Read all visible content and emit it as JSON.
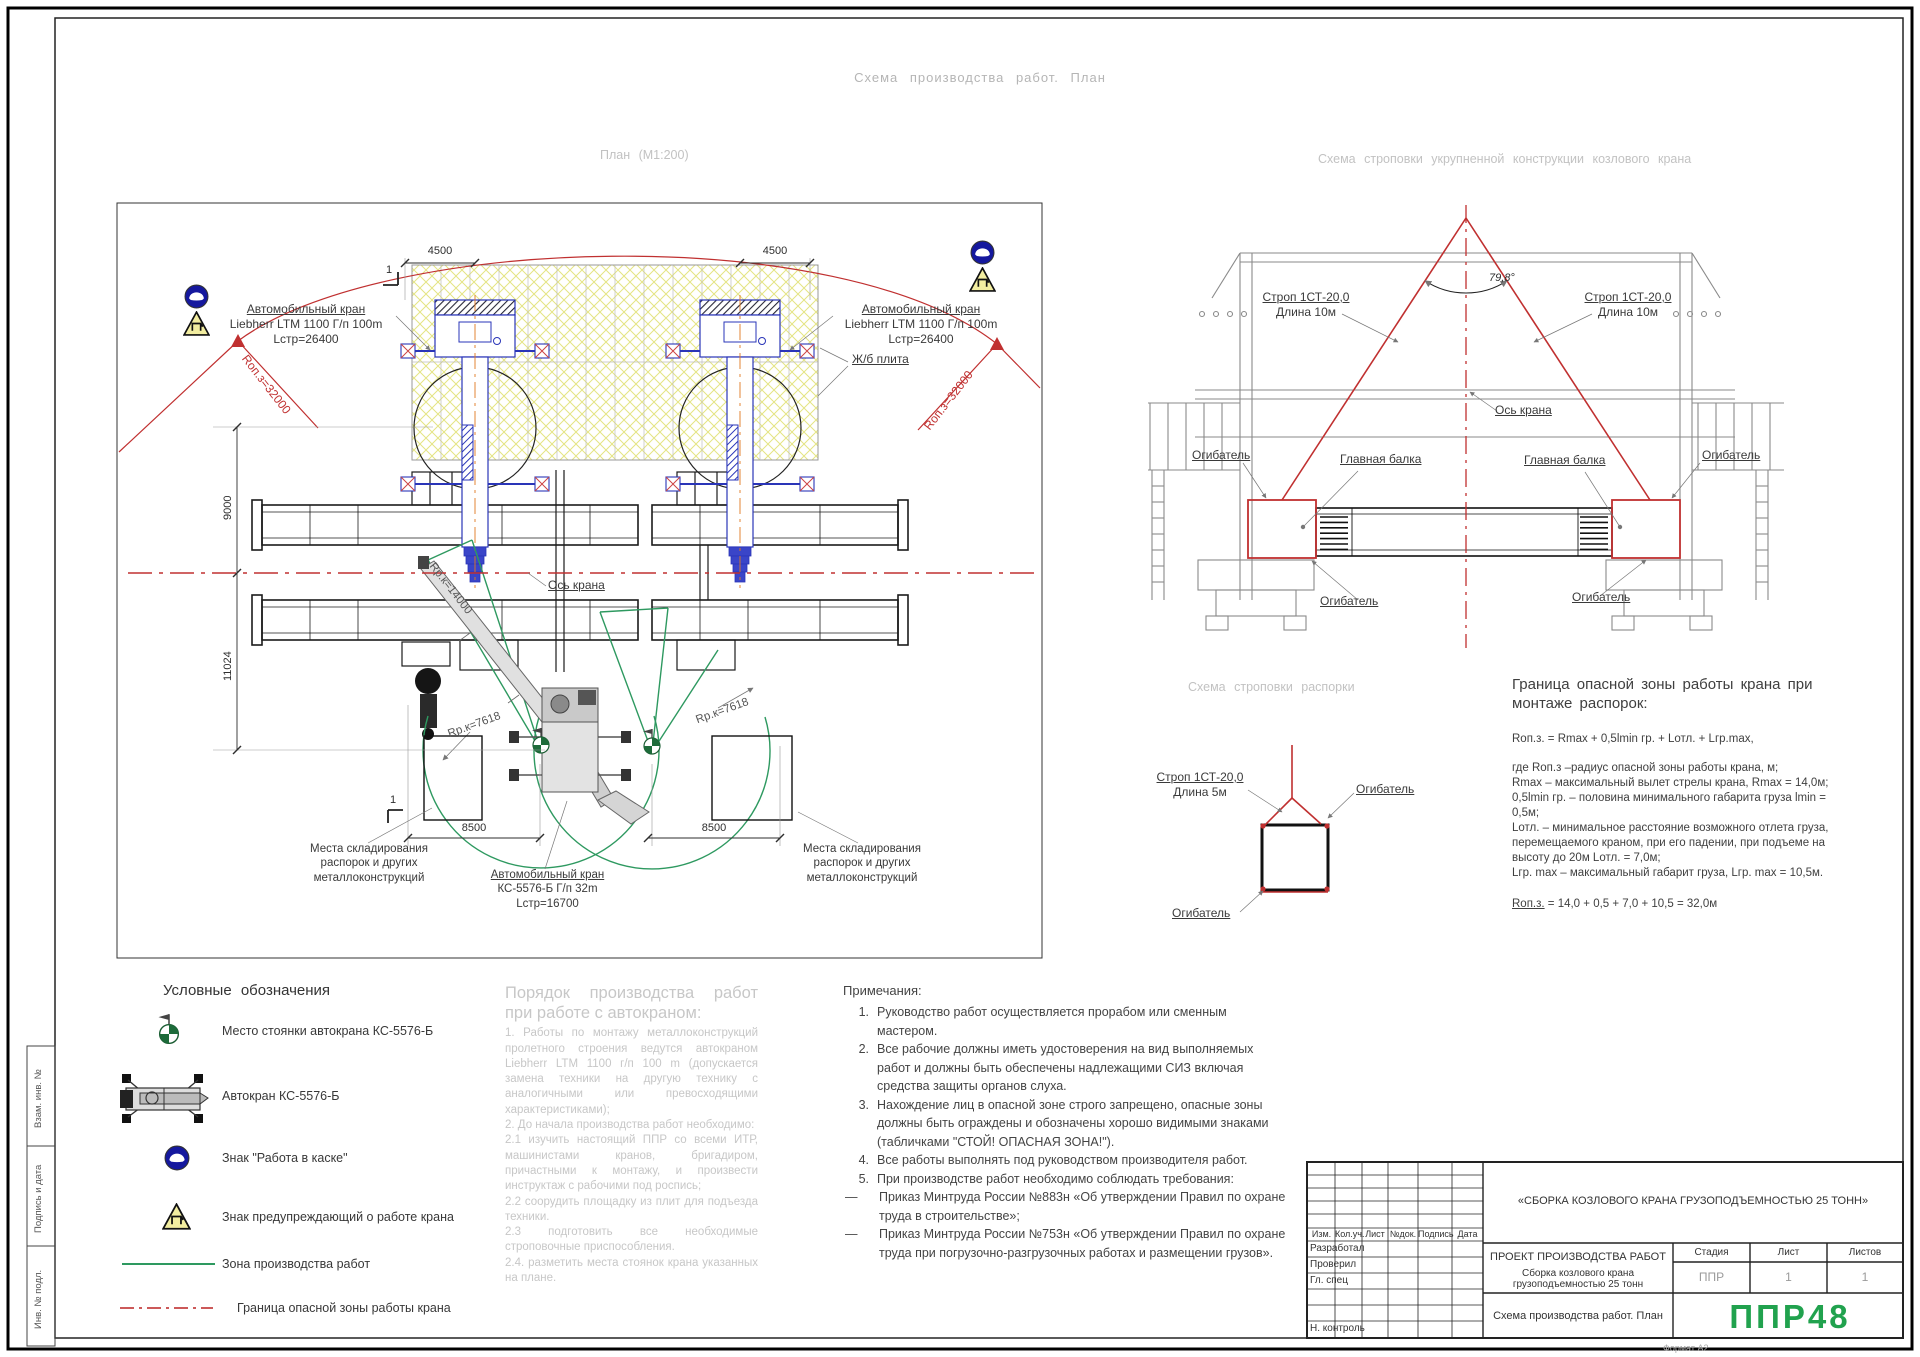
{
  "sheet": {
    "main_title": "Схема производства работ. План",
    "format_note": "Формат А2"
  },
  "margin_boxes": {
    "box1": "Взам. инв. №",
    "box2": "Подпись и дата",
    "box3": "Инв. № подл."
  },
  "plan": {
    "title": "План (М1:200)",
    "section_mark": "1",
    "dim_4500": "4500",
    "dim_9000": "9000",
    "dim_11024": "11024",
    "dim_8500": "8500",
    "auto_crane_label": {
      "line1": "Автомобильный кран",
      "line2": "Liebherr LTM 1100 Г/п 100m",
      "line3": "Lстр=26400"
    },
    "slab_label": "Ж/б плита",
    "danger_radius_label": "Rоп.з=32000",
    "axis_label": "Ось крана",
    "work_radius_label": "Rр.к=14000",
    "small_radius_label": "Rр.к=7618",
    "storage_label": {
      "line1": "Места складирования",
      "line2": "распорок и других",
      "line3": "металлоконструкций"
    },
    "ks_crane_label": {
      "line1": "Автомобильный кран",
      "line2": "КС-5576-Б Г/п 32m",
      "line3": "Lстр=16700"
    }
  },
  "sling_scheme": {
    "title": "Схема строповки укрупненной конструкции козлового крана",
    "angle_label": "79,8°",
    "sling_label": {
      "line1": "Строп 1СТ-20,0",
      "line2": "Длина 10м"
    },
    "axis_label": "Ось крана",
    "main_beam_label": "Главная балка",
    "wrap_label": "Огибатель"
  },
  "spacer_scheme": {
    "title": "Схема строповки распорки",
    "sling_label": {
      "line1": "Строп 1СТ-20,0",
      "line2": "Длина 5м"
    },
    "wrap_label": "Огибатель"
  },
  "danger_zone_text": {
    "title_line1": "Граница опасной зоны работы крана при",
    "title_line2": "монтаже распорок:",
    "formula": "Rоп.з. = Rmax + 0,5lmin гр. + Lотл. + Lгр.max,",
    "lines": [
      "где Rоп.з –радиус опасной зоны работы крана, м;",
      "Rmax  – максимальный вылет стрелы крана, Rmax = 14,0м;",
      "0,5lmin гр. – половина минимального габарита груза lmin =",
      "0,5м;",
      "Lотл. – минимальное расстояние возможного отлета груза,",
      "перемещаемого краном, при его падении, при подъеме на",
      "высоту до 20м Lотл. = 7,0м;",
      "Lгр. max – максимальный габарит груза, Lгр. max = 10,5м."
    ],
    "result_label": "Rоп.з.",
    "result_rest": " = 14,0 + 0,5 + 7,0 + 10,5 = 32,0м"
  },
  "legend": {
    "title": "Условные обозначения",
    "items": [
      {
        "label": "Место стоянки автокрана КС-5576-Б"
      },
      {
        "label": "Автокран КС-5576-Б"
      },
      {
        "label": "Знак \"Работа в каске\""
      },
      {
        "label": "Знак предупреждающий о работе крана"
      },
      {
        "label": "Зона производства работ"
      },
      {
        "label": "Граница опасной зоны работы крана"
      }
    ]
  },
  "order_text": {
    "title": "Порядок производства работ при работе с автокраном:",
    "items": [
      "1. Работы по монтажу металлоконструкций пролетного строения ведутся автокраном Liebherr LTM 1100 г/п 100 m (допускается замена техники на другую технику с аналогичными или превосходящими характеристиками);",
      "2. До начала производства работ необходимо:",
      "2.1 изучить настоящий ППР со всеми ИТР, машинистами кранов, бригадиром, причастными к монтажу, и произвести инструктаж с рабочими под роспись;",
      "2.2 соорудить площадку из плит для подъезда техники.",
      "2.3 подготовить все необходимые строповочные приспособления.",
      "2.4. разметить места стоянок крана указанных на плане."
    ]
  },
  "notes": {
    "title": "Примечания:",
    "items": [
      {
        "num": "1.",
        "text": "Руководство работ осуществляется прорабом или сменным мастером."
      },
      {
        "num": "2.",
        "text": "Все рабочие должны иметь удостоверения на вид выполняемых работ и должны быть обеспечены надлежащими СИЗ включая средства защиты органов слуха."
      },
      {
        "num": "3.",
        "text": "Нахождение лиц в опасной зоне  строго запрещено, опасные зоны должны быть ограждены и обозначены хорошо видимыми знаками (табличками \"СТОЙ! ОПАСНАЯ ЗОНА!\")."
      },
      {
        "num": "4.",
        "text": "Все работы выполнять под руководством производителя работ."
      },
      {
        "num": "5.",
        "text": "При производстве работ необходимо соблюдать требования:"
      },
      {
        "num": "—",
        "text": "Приказ Минтруда России №883н «Об утверждении Правил по охране труда в строительстве»;"
      },
      {
        "num": "—",
        "text": "Приказ Минтруда России №753н «Об утверждении Правил по охране труда при погрузочно-разгрузочных работах и размещении грузов»."
      }
    ]
  },
  "title_block": {
    "project_name": "«СБОРКА КОЗЛОВОГО КРАНА ГРУЗОПОДЪЕМНОСТЬЮ 25 ТОНН»",
    "doc_line1": "ПРОЕКТ ПРОИЗВОДСТВА РАБОТ",
    "doc_line2": "Сборка козлового крана грузоподъемностью 25 тонн",
    "sheet_title": "Схема производства работ. План",
    "cols": {
      "izm": "Изм.",
      "koluch": "Кол.уч.",
      "list": "Лист",
      "ndok": "№док.",
      "podpis": "Подпись",
      "data": "Дата"
    },
    "rows": {
      "razrabotal": "Разработал",
      "proveril": "Проверил",
      "glspec": "Гл. спец",
      "nkontrol": "Н. контроль"
    },
    "stage_label": "Стадия",
    "list_label": "Лист",
    "listov_label": "Листов",
    "stage_value": "ППР",
    "list_value": "1",
    "listov_value": "1",
    "logo": "ППР48"
  },
  "colors": {
    "accent_red": "#c03030",
    "zone_green": "#2e8b57",
    "crane_blue": "#2a35b8",
    "logo_green": "#21a24e",
    "slab_yellow": "#e4e483"
  }
}
